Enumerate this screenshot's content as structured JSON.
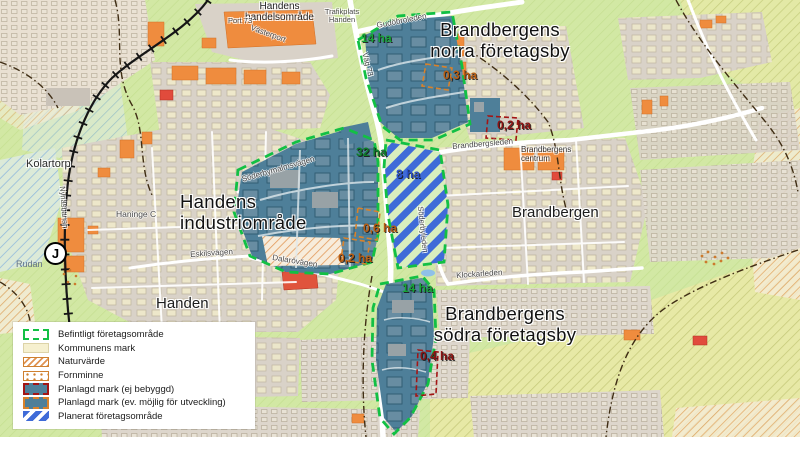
{
  "map": {
    "places": {
      "kolartorp": "Kolartorp",
      "handens_handelsomrade": "Handens\nhandelsområde",
      "trafikplats_handen": "Trafikplats\nHanden",
      "port_73": "Port 73",
      "vasterport": "Västerport",
      "haninge_c": "Haninge C",
      "rudan": "Rudan",
      "handen": "Handen",
      "brandbergen": "Brandbergen",
      "brandbergens_centrum": "Brandbergens\ncentrum",
      "station": "J"
    },
    "area_titles": {
      "norra": "Brandbergens\nnorra företagsby",
      "industri": "Handens\nindustriområde",
      "sodra": "Brandbergens\nsödra företagsby"
    },
    "roads": {
      "gudobroleden": "Gudöbroleden",
      "vag_73": "Väg 73",
      "nynasbanan": "Nynäsbanan",
      "soderbymalmsvagen": "Söderbymalmsvägen",
      "eskilsvagen": "Eskilsvägen",
      "dalarovagen": "Dalarövägen",
      "brandbergsleden": "Brandbergsleden",
      "soderbyleden": "Söderbyleden",
      "klockarleden": "Klockarleden"
    },
    "area_sizes": {
      "norra_14": "14 ha",
      "norra_03": "0,3 ha",
      "norra_02": "0,2 ha",
      "industri_32": "32 ha",
      "planned_8": "8 ha",
      "industri_06": "0,6 ha",
      "industri_02": "0,2 ha",
      "sodra_14": "14 ha",
      "sodra_04": "0,4 ha"
    }
  },
  "legend": {
    "items": [
      {
        "label": "Befintligt företagsområde",
        "swatch": "existing-area-outline"
      },
      {
        "label": "Kommunens mark",
        "swatch": "municipal-land"
      },
      {
        "label": "Naturvärde",
        "swatch": "nature-value"
      },
      {
        "label": "Fornminne",
        "swatch": "ancient-monument"
      },
      {
        "label": "Planlagd mark (ej bebyggd)",
        "swatch": "planned-undeveloped"
      },
      {
        "label": "Planlagd mark (ev. möjlig för utveckling)",
        "swatch": "planned-developable"
      },
      {
        "label": "Planerat företagsområde",
        "swatch": "planned-business-area"
      }
    ]
  },
  "colors": {
    "existing_outline": "#12c044",
    "planned_fill": "#4e7f99",
    "planned_stripes": "#3f6bd8",
    "undeveloped_outline": "#a31515",
    "developable_outline": "#d9822b",
    "size_green": "#16a336",
    "size_orange": "#b85c10",
    "size_darkred": "#8c1212",
    "size_blue": "#2b50c8",
    "background_green": "#d2e8a4",
    "urban_gray": "#d9d2c8",
    "building_orange": "#ef8c3e"
  }
}
